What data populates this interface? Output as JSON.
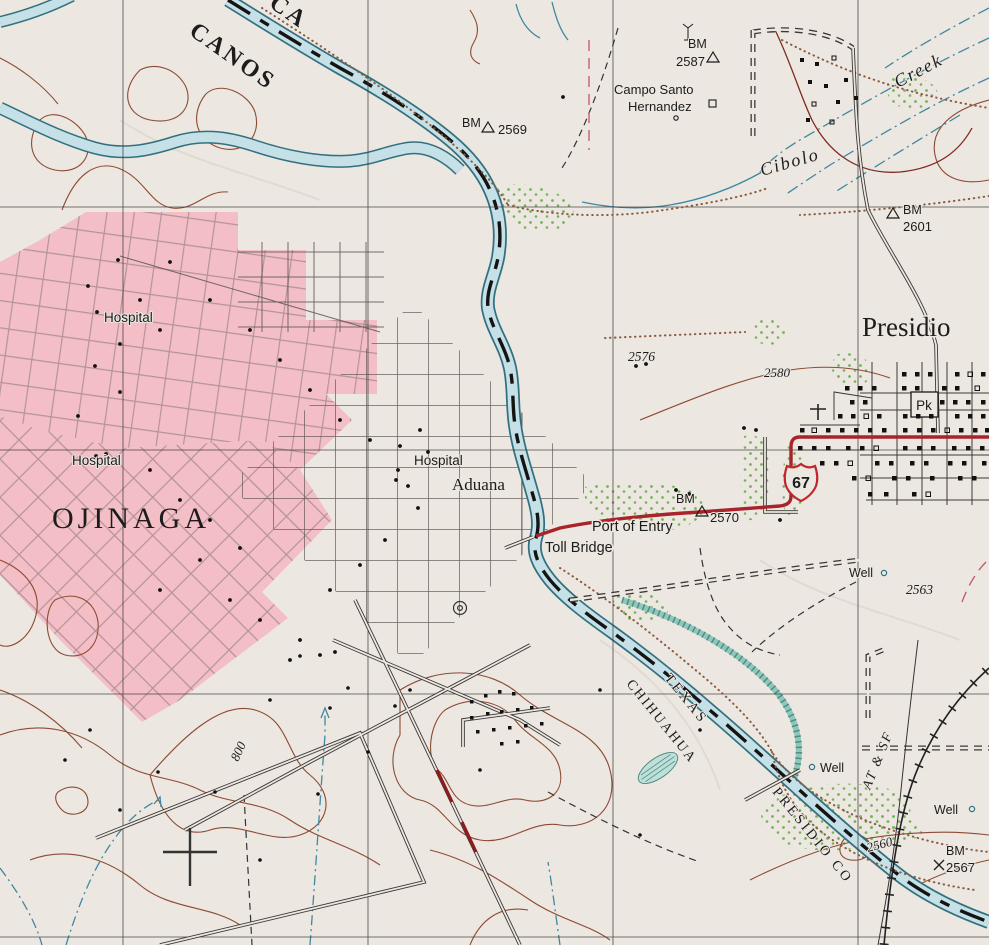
{
  "map": {
    "boundary": {
      "line1": "CA",
      "line2": "CANOS"
    },
    "cities": {
      "ojinaga": "OJINAGA",
      "presidio": "Presidio"
    },
    "pois": {
      "hospital_nw": "Hospital",
      "hospital_w": "Hospital",
      "hospital_e": "Hospital",
      "aduana": "Aduana",
      "toll_bridge": "Toll Bridge",
      "port_of_entry": "Port of Entry",
      "campo_santo_line1": "Campo Santo",
      "campo_santo_line2": "Hernandez",
      "park": "Pk",
      "well_center": "Well",
      "well_south": "Well",
      "well_east": "Well"
    },
    "hydro": {
      "creek_word1": "Cibolo",
      "creek_word2": "Creek"
    },
    "admin": {
      "state_us": "TEXAS",
      "state_mx": "CHIHUAHUA",
      "county": "PRESIDIO  CO"
    },
    "rail": {
      "name": "AT & SF"
    },
    "routes": {
      "us67": "67"
    },
    "benchmarks": {
      "b2587": {
        "prefix": "BM",
        "value": "2587"
      },
      "b2569": {
        "prefix": "BM",
        "value": "2569"
      },
      "b2601": {
        "prefix": "BM",
        "value": "2601"
      },
      "b2570": {
        "prefix": "BM",
        "value": "2570"
      },
      "b2567": {
        "prefix": "BM",
        "value": "2567"
      }
    },
    "elevations": {
      "s2576": "2576",
      "s2563": "2563",
      "c2580": "2580",
      "c2560": "2560",
      "c800": "800"
    },
    "colors": {
      "paper": "#ece7e1",
      "urban_pink": "#f4bec6",
      "water_fill": "#c5e1e7",
      "water_edge": "#33707f",
      "vegetation": "#76b258",
      "contour": "#8d4a33",
      "highway_red": "#a8232a",
      "boundary_dash": "#141414"
    }
  }
}
